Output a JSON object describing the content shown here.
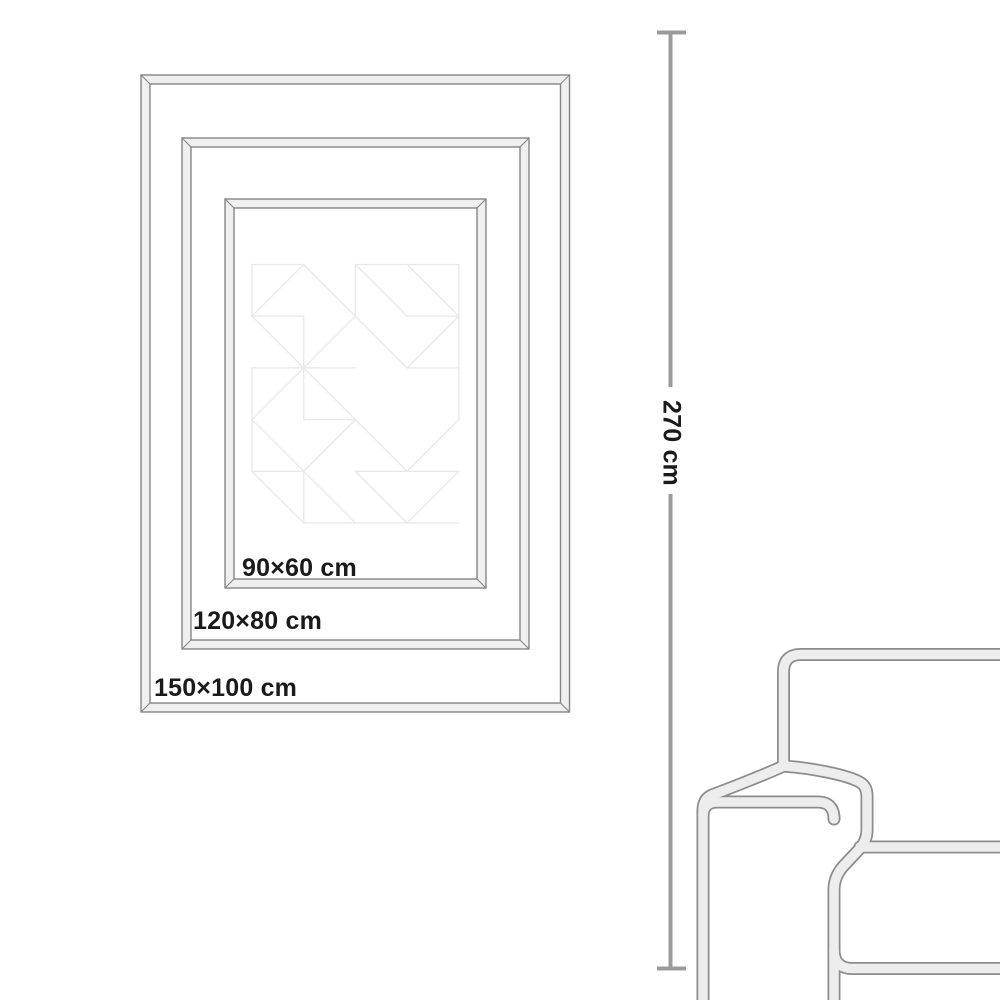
{
  "colors": {
    "page_background": "#ffffff",
    "frame_fill": "#efefef",
    "frame_line": "#858585",
    "pattern_line": "#e8e8ea",
    "text_color": "#1a1a1a",
    "measure_line": "#9b9b9b",
    "sofa_fill": "#ededed",
    "sofa_outline": "#8d8d8d"
  },
  "size_guide": {
    "frames": [
      {
        "label": "150×100 cm"
      },
      {
        "label": "120×80 cm"
      },
      {
        "label": "90×60 cm"
      }
    ],
    "height_dimension": {
      "label": "270 cm"
    }
  }
}
